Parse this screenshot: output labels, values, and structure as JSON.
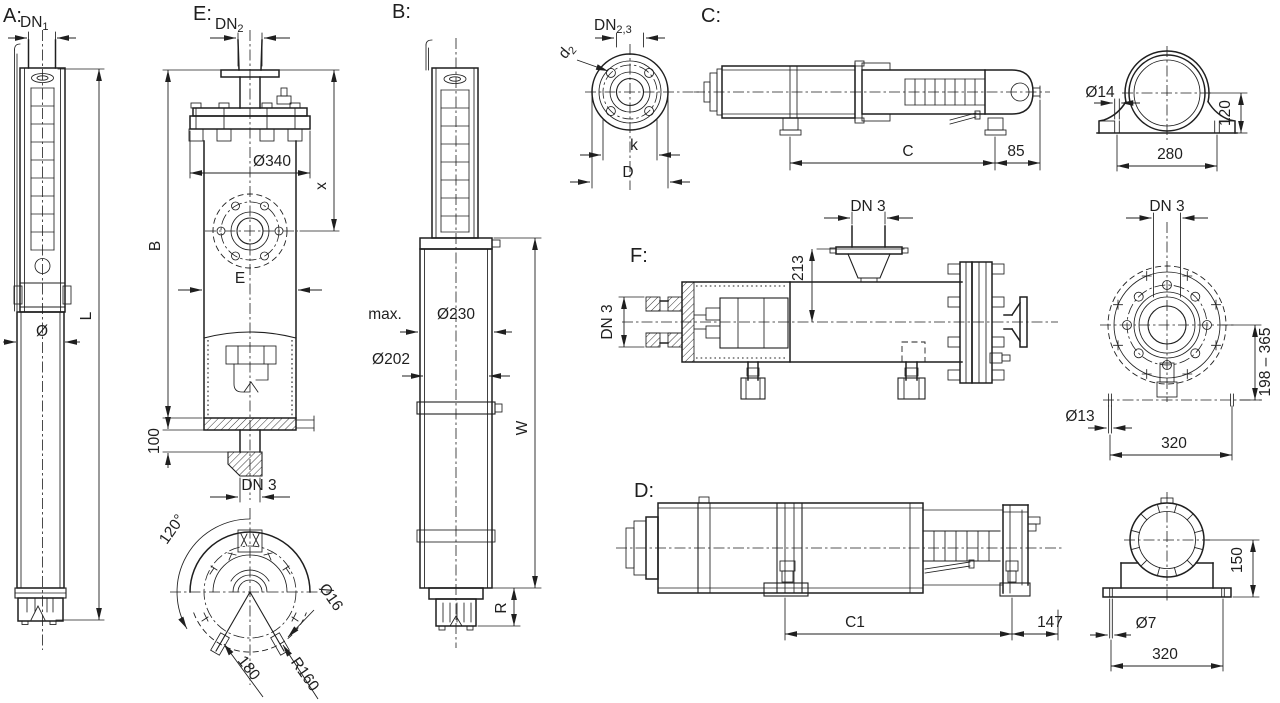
{
  "colors": {
    "line": "#1f1f1f",
    "background": "#ffffff"
  },
  "views": {
    "a": {
      "tag": "A:",
      "dn1_base": "DN",
      "dn1_sub": "1",
      "dia": "Ø",
      "length": "L"
    },
    "e": {
      "tag": "E:",
      "dn2_base": "DN",
      "dn2_sub": "2",
      "dia340": "Ø340",
      "dim_x": "x",
      "dim_b": "B",
      "dim_e": "E",
      "dim_100": "100",
      "dn3": "DN 3",
      "angle": "120°",
      "chord": "180",
      "radius": "R160",
      "slot_dia": "Ø16"
    },
    "b": {
      "tag": "B:",
      "max_label": "max.",
      "dia230": "Ø230",
      "dia202": "Ø202",
      "width": "W",
      "radius": "R"
    },
    "flange_top": {
      "dn_base": "DN",
      "dn_sub": "2,3",
      "d2_base": "d",
      "d2_sub": "2",
      "bolt_circle": "k",
      "outer_dia": "D"
    },
    "c": {
      "tag": "C:",
      "length": "C",
      "end_offset": "85"
    },
    "clamp": {
      "hole_dia": "Ø14",
      "height": "120",
      "spacing": "280"
    },
    "f": {
      "tag": "F:",
      "dn3_left": "DN 3",
      "dn3_top": "DN 3",
      "height": "213"
    },
    "flange_right": {
      "dn3": "DN 3",
      "range": "198 – 365",
      "hole_dia": "Ø13",
      "spacing": "320"
    },
    "d": {
      "tag": "D:",
      "length": "C1",
      "end_offset": "147"
    },
    "cradle": {
      "height": "150",
      "hole_dia": "Ø7",
      "spacing": "320"
    }
  }
}
